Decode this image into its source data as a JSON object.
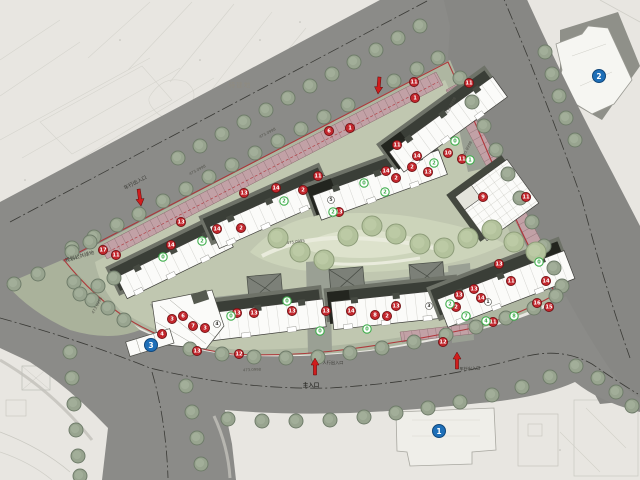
{
  "plan": {
    "labels": {
      "pending_land": "待建地",
      "planned_public_green": "规划公共绿地",
      "vehicle_entrance_nw": "车行出入口",
      "vehicle_entrance_se": "车行出入口",
      "pedestrian_entrance": "人行出入口",
      "main_entrance": "主入口"
    },
    "spot_elevations": [
      [
        198,
        171,
        -28,
        "473.0998"
      ],
      [
        268,
        134,
        -28,
        "473.0998"
      ],
      [
        452,
        106,
        -62,
        "435.8998"
      ],
      [
        468,
        150,
        -62,
        "435.8998"
      ],
      [
        296,
        243,
        -8,
        "475.0995"
      ],
      [
        98,
        306,
        -62,
        "473.0998"
      ],
      [
        252,
        371,
        -2,
        "473.0998"
      ]
    ],
    "markers": {
      "red": [
        [
          329,
          131,
          "6"
        ],
        [
          350,
          128,
          "1"
        ],
        [
          414,
          82,
          "11"
        ],
        [
          415,
          98,
          "1"
        ],
        [
          469,
          83,
          "11"
        ],
        [
          397,
          145,
          "11"
        ],
        [
          417,
          156,
          "14"
        ],
        [
          412,
          167,
          "2"
        ],
        [
          428,
          172,
          "13"
        ],
        [
          448,
          153,
          "10"
        ],
        [
          462,
          159,
          "11"
        ],
        [
          386,
          171,
          "14"
        ],
        [
          396,
          178,
          "2"
        ],
        [
          318,
          176,
          "11"
        ],
        [
          339,
          212,
          "13"
        ],
        [
          303,
          190,
          "2"
        ],
        [
          276,
          188,
          "14"
        ],
        [
          244,
          193,
          "13"
        ],
        [
          241,
          228,
          "2"
        ],
        [
          217,
          229,
          "14"
        ],
        [
          181,
          222,
          "13"
        ],
        [
          171,
          245,
          "14"
        ],
        [
          116,
          255,
          "11"
        ],
        [
          103,
          250,
          "17"
        ],
        [
          483,
          197,
          "9"
        ],
        [
          526,
          197,
          "11"
        ],
        [
          172,
          319,
          "3"
        ],
        [
          183,
          316,
          "6"
        ],
        [
          193,
          326,
          "7"
        ],
        [
          205,
          328,
          "3"
        ],
        [
          162,
          334,
          "4"
        ],
        [
          197,
          351,
          "13"
        ],
        [
          237,
          313,
          "13"
        ],
        [
          254,
          313,
          "13"
        ],
        [
          292,
          311,
          "13"
        ],
        [
          239,
          354,
          "12"
        ],
        [
          443,
          342,
          "12"
        ],
        [
          326,
          311,
          "13"
        ],
        [
          351,
          311,
          "14"
        ],
        [
          375,
          315,
          "8"
        ],
        [
          387,
          316,
          "2"
        ],
        [
          396,
          306,
          "13"
        ],
        [
          459,
          295,
          "13"
        ],
        [
          474,
          289,
          "13"
        ],
        [
          481,
          298,
          "14"
        ],
        [
          499,
          264,
          "13"
        ],
        [
          511,
          281,
          "11"
        ],
        [
          546,
          281,
          "14"
        ],
        [
          537,
          303,
          "16"
        ],
        [
          549,
          307,
          "15"
        ],
        [
          493,
          322,
          "11"
        ],
        [
          456,
          307,
          "2"
        ]
      ],
      "green": [
        [
          163,
          257,
          "0"
        ],
        [
          202,
          241,
          "2"
        ],
        [
          284,
          201,
          "2"
        ],
        [
          333,
          212,
          "2"
        ],
        [
          364,
          183,
          "0"
        ],
        [
          385,
          192,
          "2"
        ],
        [
          434,
          163,
          "2"
        ],
        [
          455,
          141,
          "0"
        ],
        [
          470,
          160,
          "1"
        ],
        [
          231,
          316,
          "0"
        ],
        [
          287,
          301,
          "0"
        ],
        [
          320,
          331,
          "0"
        ],
        [
          367,
          329,
          "0"
        ],
        [
          450,
          304,
          "2"
        ],
        [
          466,
          316,
          "7"
        ],
        [
          486,
          321,
          "4"
        ],
        [
          514,
          316,
          "8"
        ],
        [
          539,
          262,
          "0"
        ]
      ],
      "blue": [
        [
          151,
          345,
          "3"
        ],
        [
          599,
          76,
          "2"
        ],
        [
          439,
          431,
          "1"
        ]
      ],
      "building_units": [
        [
          331,
          200,
          "5"
        ],
        [
          217,
          324,
          "4"
        ],
        [
          429,
          306,
          "3"
        ],
        [
          488,
          302,
          "1"
        ]
      ]
    },
    "colors": {
      "red_badge": "#c2262c",
      "green_badge": "#3fae4c",
      "blue_badge": "#1e6fb8",
      "arrow": "#cf1d1d",
      "boundary": "#ae2c31"
    }
  }
}
